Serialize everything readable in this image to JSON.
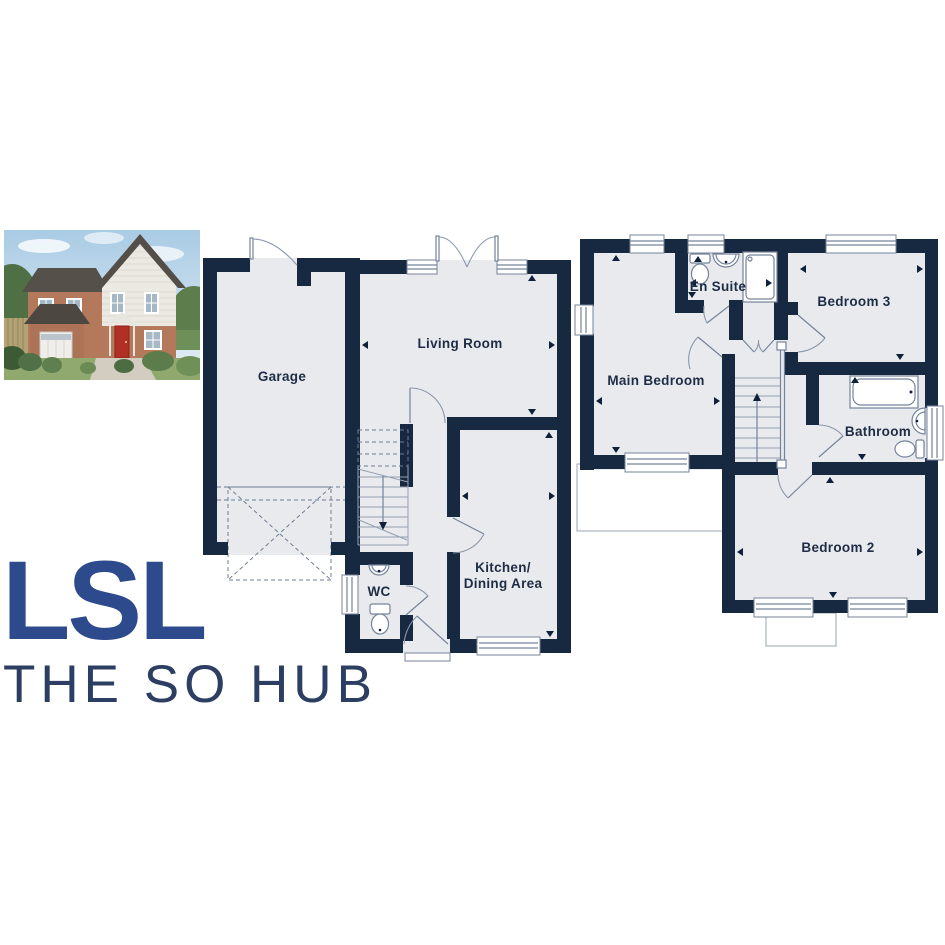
{
  "brand": {
    "logo": "LSL",
    "tagline": "THE SO HUB",
    "logo_color": "#2c4a8c",
    "tagline_color": "#2d3e63"
  },
  "floor_plans": {
    "ground": {
      "garage": "Garage",
      "living_room": "Living Room",
      "wc": "WC",
      "kitchen_line1": "Kitchen/",
      "kitchen_line2": "Dining Area"
    },
    "first": {
      "en_suite": "En Suite",
      "bedroom_3": "Bedroom 3",
      "main_bedroom": "Main Bedroom",
      "bathroom": "Bathroom",
      "bedroom_2": "Bedroom 2"
    }
  },
  "colors": {
    "wall": "#172940",
    "room_fill": "#e8eaee",
    "plan_line": "#76839a",
    "label_text": "#1e2d45"
  }
}
